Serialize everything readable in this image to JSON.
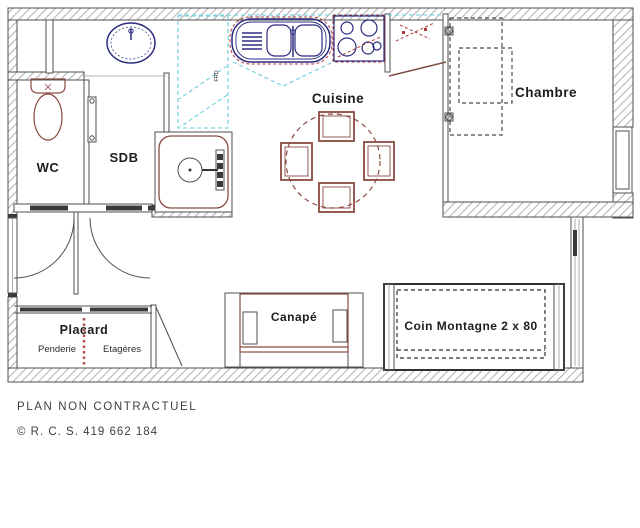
{
  "plan": {
    "rooms": {
      "wc": "WC",
      "sdb": "SDB",
      "cuisine": "Cuisine",
      "chambre": "Chambre"
    },
    "furniture": {
      "placard": "Placard",
      "penderie": "Penderie",
      "etageres": "Etagères",
      "canape": "Canapé",
      "coin_montagne": "Coin Montagne 2 x 80"
    },
    "kitchen_code": "FRD"
  },
  "footer": {
    "disclaimer": "PLAN NON CONTRACTUEL",
    "copyright": "© R. C. S. 419 662 184"
  },
  "colors": {
    "wall_line": "#4f4f4f",
    "hatch": "#b5b5b5",
    "fixture_navy": "#2b2b80",
    "fixture_brown": "#8a4a42",
    "counter_cyan": "#7fd4e0",
    "accent_red": "#b03a3a",
    "placard_divider_red": "#b05050",
    "label_text": "#1d1d1d",
    "footer_text": "#3f3f3f"
  }
}
